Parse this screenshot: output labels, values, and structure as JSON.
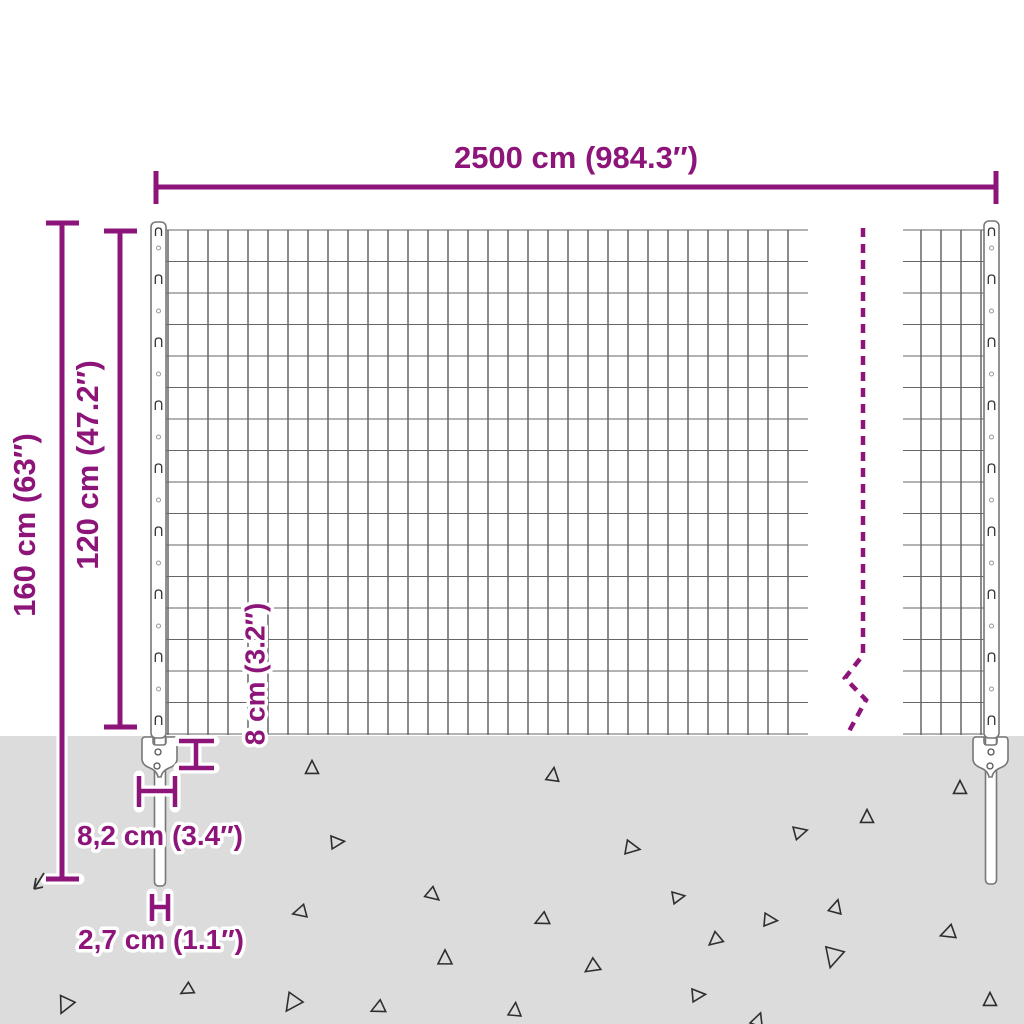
{
  "colors": {
    "accent": "#8d157a",
    "ground": "#dcdcdc",
    "wire_dark": "#3f3f3f",
    "wire_light": "#666666",
    "debris_outline": "#2e2e2e",
    "steel_outline": "#777777"
  },
  "dimensions": {
    "total_width": {
      "label": "2500 cm (984.3″)"
    },
    "total_height": {
      "label": "160 cm (63″)"
    },
    "fence_height": {
      "label": "120 cm (47.2″)"
    },
    "anchor_depth": {
      "label": "8 cm (3.2″)"
    },
    "anchor_width": {
      "label": "8,2 cm (3.4″)"
    },
    "spike_width": {
      "label": "2,7 cm (1.1″)"
    }
  }
}
